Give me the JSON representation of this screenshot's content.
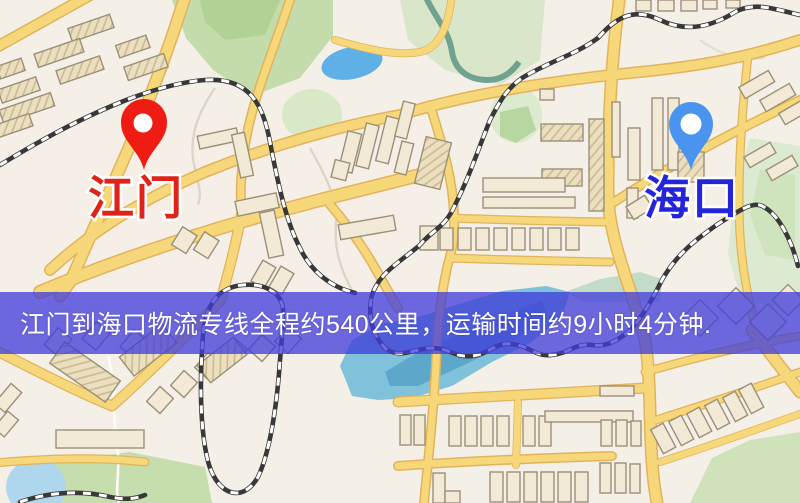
{
  "window": {
    "width": 800,
    "height": 503
  },
  "map": {
    "kind": "road-map-with-route-overlay",
    "origin": {
      "name": "江门",
      "pin_icon": "red-map-pin",
      "pin_color": "#ee1c12",
      "label_color": "#e02318"
    },
    "destination": {
      "name": "海口",
      "pin_icon": "blue-map-pin",
      "pin_color": "#4a94f0",
      "label_color": "#2424d8"
    },
    "banner": {
      "text": "江门到海口物流专线全程约540公里，运输时间约9小时4分钟.",
      "distance_text": "约540公里",
      "duration_text": "约9小时4分钟",
      "background": "rgba(64,61,218,0.76)",
      "text_color": "#ffffff"
    },
    "palette": {
      "background": "#f4efe7",
      "road_fill": "#f6d87a",
      "road_casing": "#e2b35c",
      "building_fill": "#f2ead6",
      "building_outline": "#9b9078",
      "park_green": "#c4dcab",
      "light_green": "#d9e8c6",
      "water_blue": "#5fb0e6",
      "lake_teal": "#7fc2da",
      "railway_dark": "#383838"
    }
  }
}
